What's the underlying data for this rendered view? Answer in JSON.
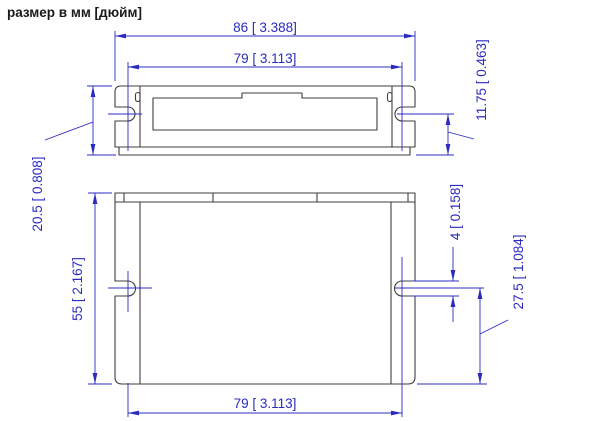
{
  "title": "размер в мм [дюйм]",
  "colors": {
    "dimension_blue": "#2b2bc0",
    "drawing_line": "#3f3f3f",
    "background": "#ffffff"
  },
  "top_view": {
    "dims": {
      "overall_width": "86 [ 3.388]",
      "mount_slot_spacing": "79 [ 3.113]",
      "overall_depth": "20.5 [ 0.808]",
      "slot_center_to_base": "11.75 [ 0.463]"
    }
  },
  "front_view": {
    "dims": {
      "body_height": "55 [ 2.167]",
      "slot_width": "4 [ 0.158]",
      "slot_center_to_bottom": "27.5 [ 1.084]",
      "mount_slot_spacing": "79 [ 3.113]"
    }
  }
}
